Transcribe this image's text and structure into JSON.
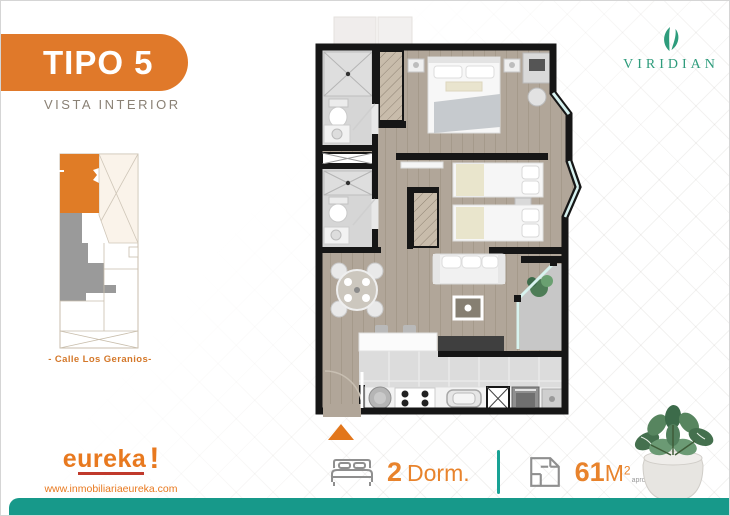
{
  "meta": {
    "accent_orange": "#e0792a",
    "teal": "#17998a",
    "brand_green": "#2e9c7c",
    "wall_color": "#161616",
    "wood_floor": "#b1a699"
  },
  "header": {
    "badge_title": "TIPO 5",
    "badge_subtitle": "VISTA INTERIOR"
  },
  "brand": {
    "name": "VIRIDIAN",
    "icon": "leaf-icon"
  },
  "site_map": {
    "caption": "- Calle Los Geranios-",
    "highlight_color": "#e07c26",
    "sold_color": "#9a9a9a"
  },
  "floorplan": {
    "rooms": [
      "bathroom-1",
      "duct",
      "bathroom-2",
      "master-bedroom",
      "bedroom-2",
      "living-dining",
      "kitchen",
      "balcony"
    ],
    "entrance_marker": "orange-triangle"
  },
  "footer": {
    "logo_text": "eureka",
    "logo_mark": "!",
    "website": "www.inmobiliariaeureka.com",
    "stats": {
      "bedrooms": {
        "icon": "bed-icon",
        "value": "2",
        "label": "Dorm."
      },
      "area": {
        "icon": "floorplan-icon",
        "value": "61",
        "unit": "M",
        "exponent": "2",
        "note": "aprox"
      }
    }
  }
}
